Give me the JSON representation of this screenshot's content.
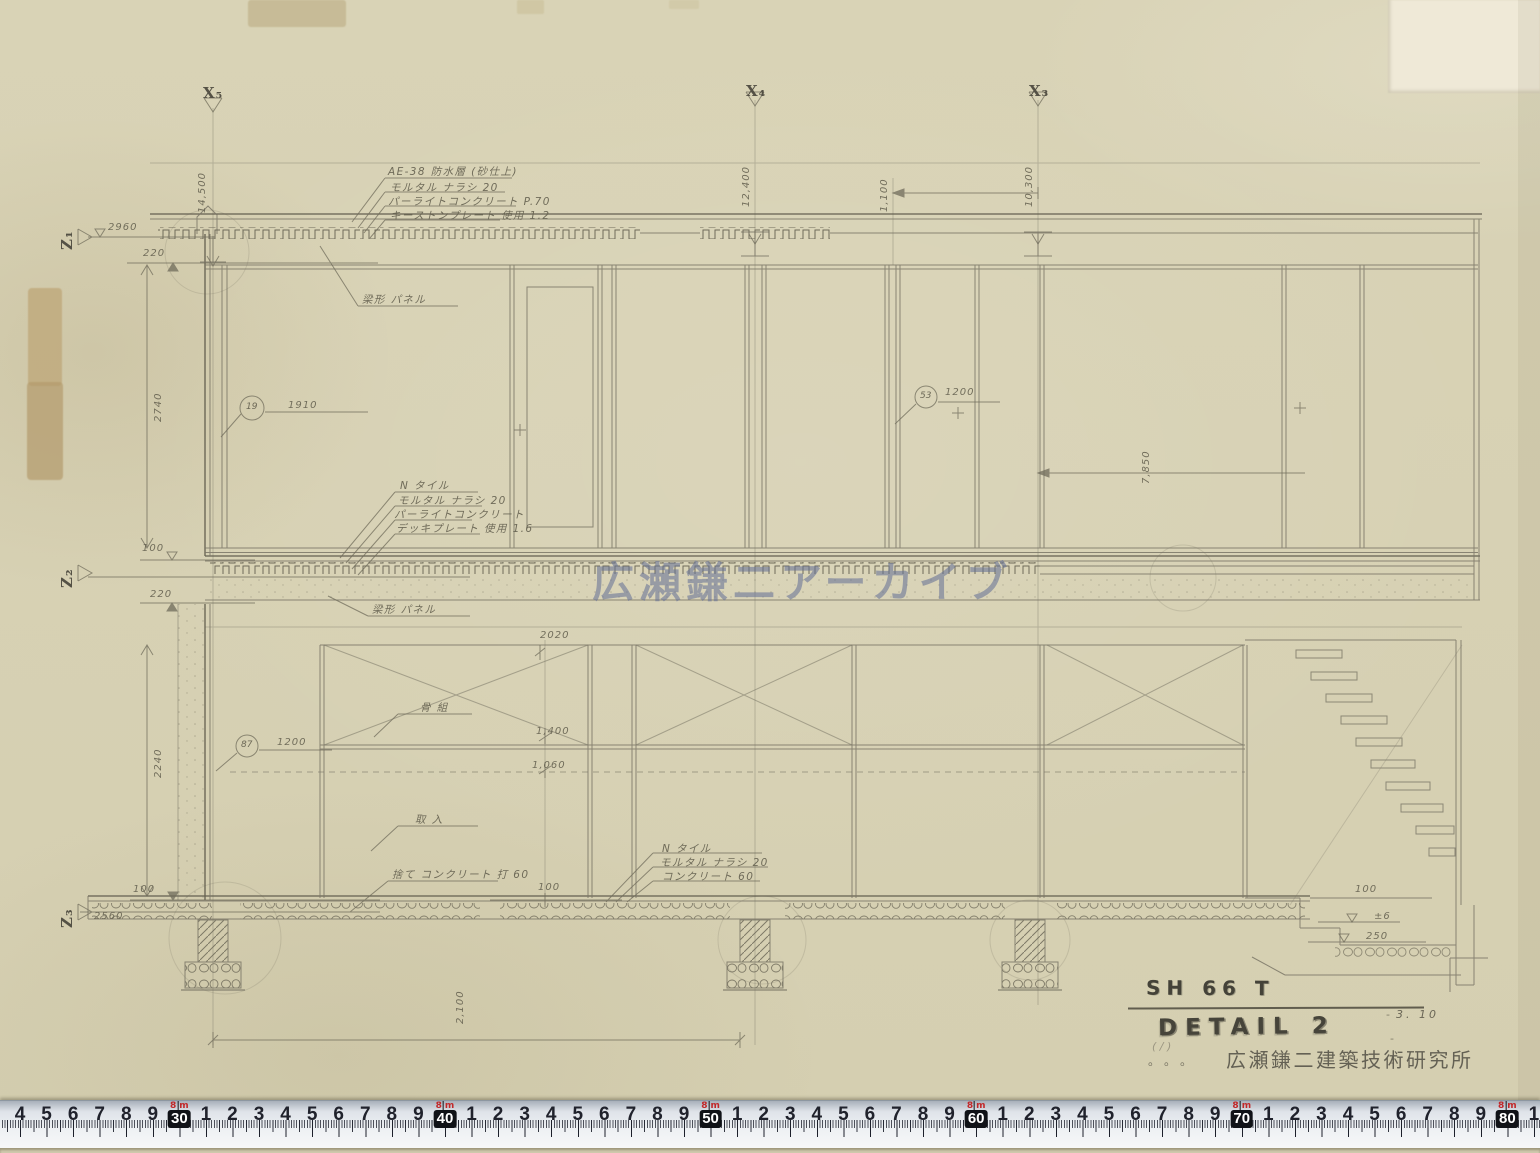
{
  "sheet": {
    "watermark": "広瀬鎌二アーカイブ",
    "title_block": {
      "project_code": "SH 66 T",
      "sheet_title": "DETAIL 2",
      "date": "3. 10",
      "office_stamp": "広瀬鎌二建築技術研究所",
      "dots": "。。。",
      "scribble": "( / )",
      "dash": "-"
    }
  },
  "ruler": {
    "meter_value": "8",
    "unit_label": "m",
    "start_cm": 24,
    "end_cm": 81,
    "px_per_cm": 26.56,
    "origin_x": 20
  },
  "annotations": [
    {
      "t": "X₅",
      "x": 203,
      "y": 84,
      "c": "grid",
      "n": "grid-label-x5"
    },
    {
      "t": "X₄",
      "x": 746,
      "y": 82,
      "c": "grid",
      "n": "grid-label-x4"
    },
    {
      "t": "X₃",
      "x": 1029,
      "y": 82,
      "c": "grid",
      "n": "grid-label-x3"
    },
    {
      "t": "Z₁",
      "x": 58,
      "y": 250,
      "r": 1,
      "c": "grid",
      "n": "grid-label-z1"
    },
    {
      "t": "Z₂",
      "x": 58,
      "y": 588,
      "r": 1,
      "c": "grid",
      "n": "grid-label-z2"
    },
    {
      "t": "Z₃",
      "x": 58,
      "y": 928,
      "r": 1,
      "c": "grid",
      "n": "grid-label-z3"
    },
    {
      "t": "AE-38 防水層 (砂仕上)",
      "x": 388,
      "y": 164,
      "c": "pencil",
      "n": "note-roof-waterproofing"
    },
    {
      "t": "モルタル ナラシ 20",
      "x": 390,
      "y": 180,
      "c": "pencil",
      "n": "note-roof-mortar"
    },
    {
      "t": "パーライトコンクリート P.70",
      "x": 388,
      "y": 194,
      "c": "pencil",
      "n": "note-roof-perlite"
    },
    {
      "t": "キーストンプレート 使用 1.2",
      "x": 390,
      "y": 208,
      "c": "pencil",
      "n": "note-roof-keystone-plate"
    },
    {
      "t": "梁形 パネル",
      "x": 362,
      "y": 292,
      "c": "pencil",
      "n": "note-beam-panel-upper"
    },
    {
      "t": "梁形 パネル",
      "x": 372,
      "y": 602,
      "c": "pencil",
      "n": "note-beam-panel-lower"
    },
    {
      "t": "N タイル",
      "x": 400,
      "y": 478,
      "c": "pencil",
      "n": "note-2f-tile"
    },
    {
      "t": "モルタル ナラシ 20",
      "x": 398,
      "y": 493,
      "c": "pencil",
      "n": "note-2f-mortar"
    },
    {
      "t": "パーライトコンクリート",
      "x": 394,
      "y": 507,
      "c": "pencil",
      "n": "note-2f-perlite"
    },
    {
      "t": "デッキプレート 使用 1.6",
      "x": 396,
      "y": 521,
      "c": "pencil",
      "n": "note-2f-deckplate"
    },
    {
      "t": "骨 組",
      "x": 420,
      "y": 700,
      "c": "pencil",
      "n": "note-frame"
    },
    {
      "t": "取 入",
      "x": 415,
      "y": 812,
      "c": "pencil",
      "n": "note-intake"
    },
    {
      "t": "捨て コンクリート 打 60",
      "x": 392,
      "y": 867,
      "c": "pencil",
      "n": "note-lean-concrete"
    },
    {
      "t": "N タイル",
      "x": 662,
      "y": 841,
      "c": "pencil",
      "n": "note-1f-tile"
    },
    {
      "t": "モルタル ナラシ 20",
      "x": 660,
      "y": 855,
      "c": "pencil",
      "n": "note-1f-mortar"
    },
    {
      "t": "コンクリート 60",
      "x": 662,
      "y": 869,
      "c": "pencil",
      "n": "note-1f-concrete"
    },
    {
      "t": "14,500",
      "x": 197,
      "y": 213,
      "r": 1,
      "c": "dim",
      "n": "dim-grid-x5"
    },
    {
      "t": "12,400",
      "x": 741,
      "y": 207,
      "r": 1,
      "c": "dim",
      "n": "dim-grid-x4"
    },
    {
      "t": "10,300",
      "x": 1024,
      "y": 207,
      "r": 1,
      "c": "dim",
      "n": "dim-grid-x3"
    },
    {
      "t": "1,100",
      "x": 879,
      "y": 212,
      "r": 1,
      "c": "dim",
      "n": "dim-1100"
    },
    {
      "t": "2960",
      "x": 108,
      "y": 222,
      "c": "dim",
      "n": "dim-2960"
    },
    {
      "t": "220",
      "x": 143,
      "y": 248,
      "c": "dim",
      "n": "dim-220-upper"
    },
    {
      "t": "2740",
      "x": 153,
      "y": 422,
      "r": 1,
      "c": "dim",
      "n": "dim-2740"
    },
    {
      "t": "1910",
      "x": 288,
      "y": 400,
      "c": "dim",
      "n": "dim-1910"
    },
    {
      "t": "1200",
      "x": 945,
      "y": 387,
      "c": "dim",
      "n": "dim-1200-upper"
    },
    {
      "t": "7,850",
      "x": 1141,
      "y": 484,
      "r": 1,
      "c": "dim",
      "n": "dim-7850"
    },
    {
      "t": "100",
      "x": 142,
      "y": 543,
      "c": "dim",
      "n": "dim-100-z2"
    },
    {
      "t": "220",
      "x": 150,
      "y": 589,
      "c": "dim",
      "n": "dim-220-z2"
    },
    {
      "t": "2020",
      "x": 540,
      "y": 630,
      "c": "dim",
      "n": "dim-2020"
    },
    {
      "t": "1,400",
      "x": 536,
      "y": 726,
      "c": "dim",
      "n": "dim-1400"
    },
    {
      "t": "1,060",
      "x": 532,
      "y": 760,
      "c": "dim",
      "n": "dim-1060"
    },
    {
      "t": "1200",
      "x": 277,
      "y": 737,
      "c": "dim",
      "n": "dim-1200-lower"
    },
    {
      "t": "2240",
      "x": 153,
      "y": 778,
      "r": 1,
      "c": "dim",
      "n": "dim-2240"
    },
    {
      "t": "100",
      "x": 133,
      "y": 884,
      "c": "dim",
      "n": "dim-100-z3"
    },
    {
      "t": "2560",
      "x": 94,
      "y": 911,
      "c": "dim",
      "n": "dim-2560"
    },
    {
      "t": "100",
      "x": 538,
      "y": 882,
      "c": "dim",
      "n": "dim-100-floor"
    },
    {
      "t": "2,100",
      "x": 455,
      "y": 1024,
      "r": 1,
      "c": "dim",
      "n": "dim-footing-span"
    },
    {
      "t": "100",
      "x": 1355,
      "y": 884,
      "c": "dim",
      "n": "dim-100-pit"
    },
    {
      "t": "±6",
      "x": 1374,
      "y": 911,
      "c": "dim",
      "n": "level-pm6"
    },
    {
      "t": "250",
      "x": 1366,
      "y": 931,
      "c": "dim",
      "n": "level-250"
    },
    {
      "t": "19",
      "x": 246,
      "y": 402,
      "c": "circ",
      "n": "detail-ref-19"
    },
    {
      "t": "53",
      "x": 920,
      "y": 391,
      "c": "circ",
      "n": "detail-ref-53"
    },
    {
      "t": "87",
      "x": 241,
      "y": 740,
      "c": "circ",
      "n": "detail-ref-87"
    }
  ]
}
